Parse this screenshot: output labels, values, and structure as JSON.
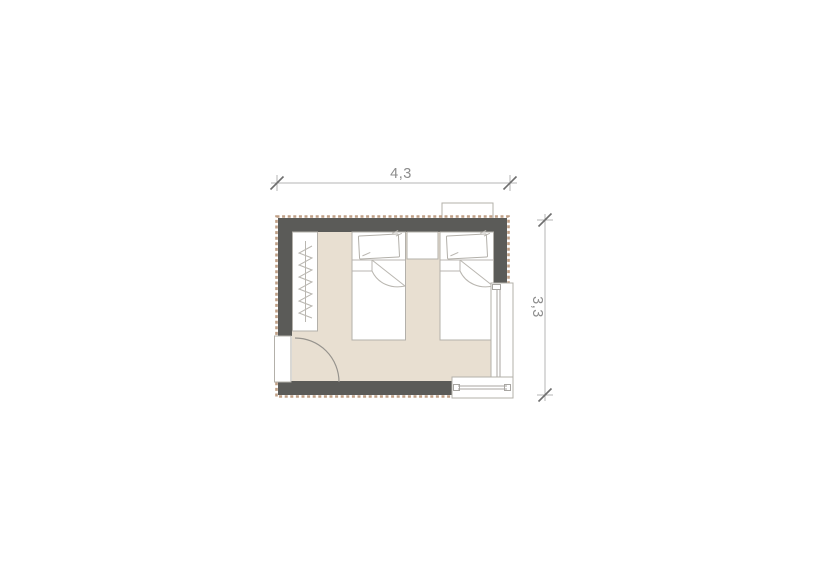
{
  "drawing": {
    "type": "floor-plan",
    "room": "twin-bedroom"
  },
  "dimensions": {
    "width_label": "4,3",
    "height_label": "3,3"
  },
  "colors": {
    "wall": "#5b5b58",
    "floor": "#e8dfd1",
    "insulation_hatch": "#bf9f85",
    "furniture_outline": "#b3b0aa",
    "dimension_line": "#b4b4b4",
    "dimension_tick": "#6e6e6e",
    "dimension_text": "#8c8c8c",
    "background": "#ffffff"
  },
  "symbols": [
    "wardrobe-hangers-icon",
    "single-bed-icon",
    "single-bed-icon",
    "nightstand-icon",
    "door-swing-icon",
    "window-icon",
    "window-icon",
    "radiator-icon"
  ]
}
